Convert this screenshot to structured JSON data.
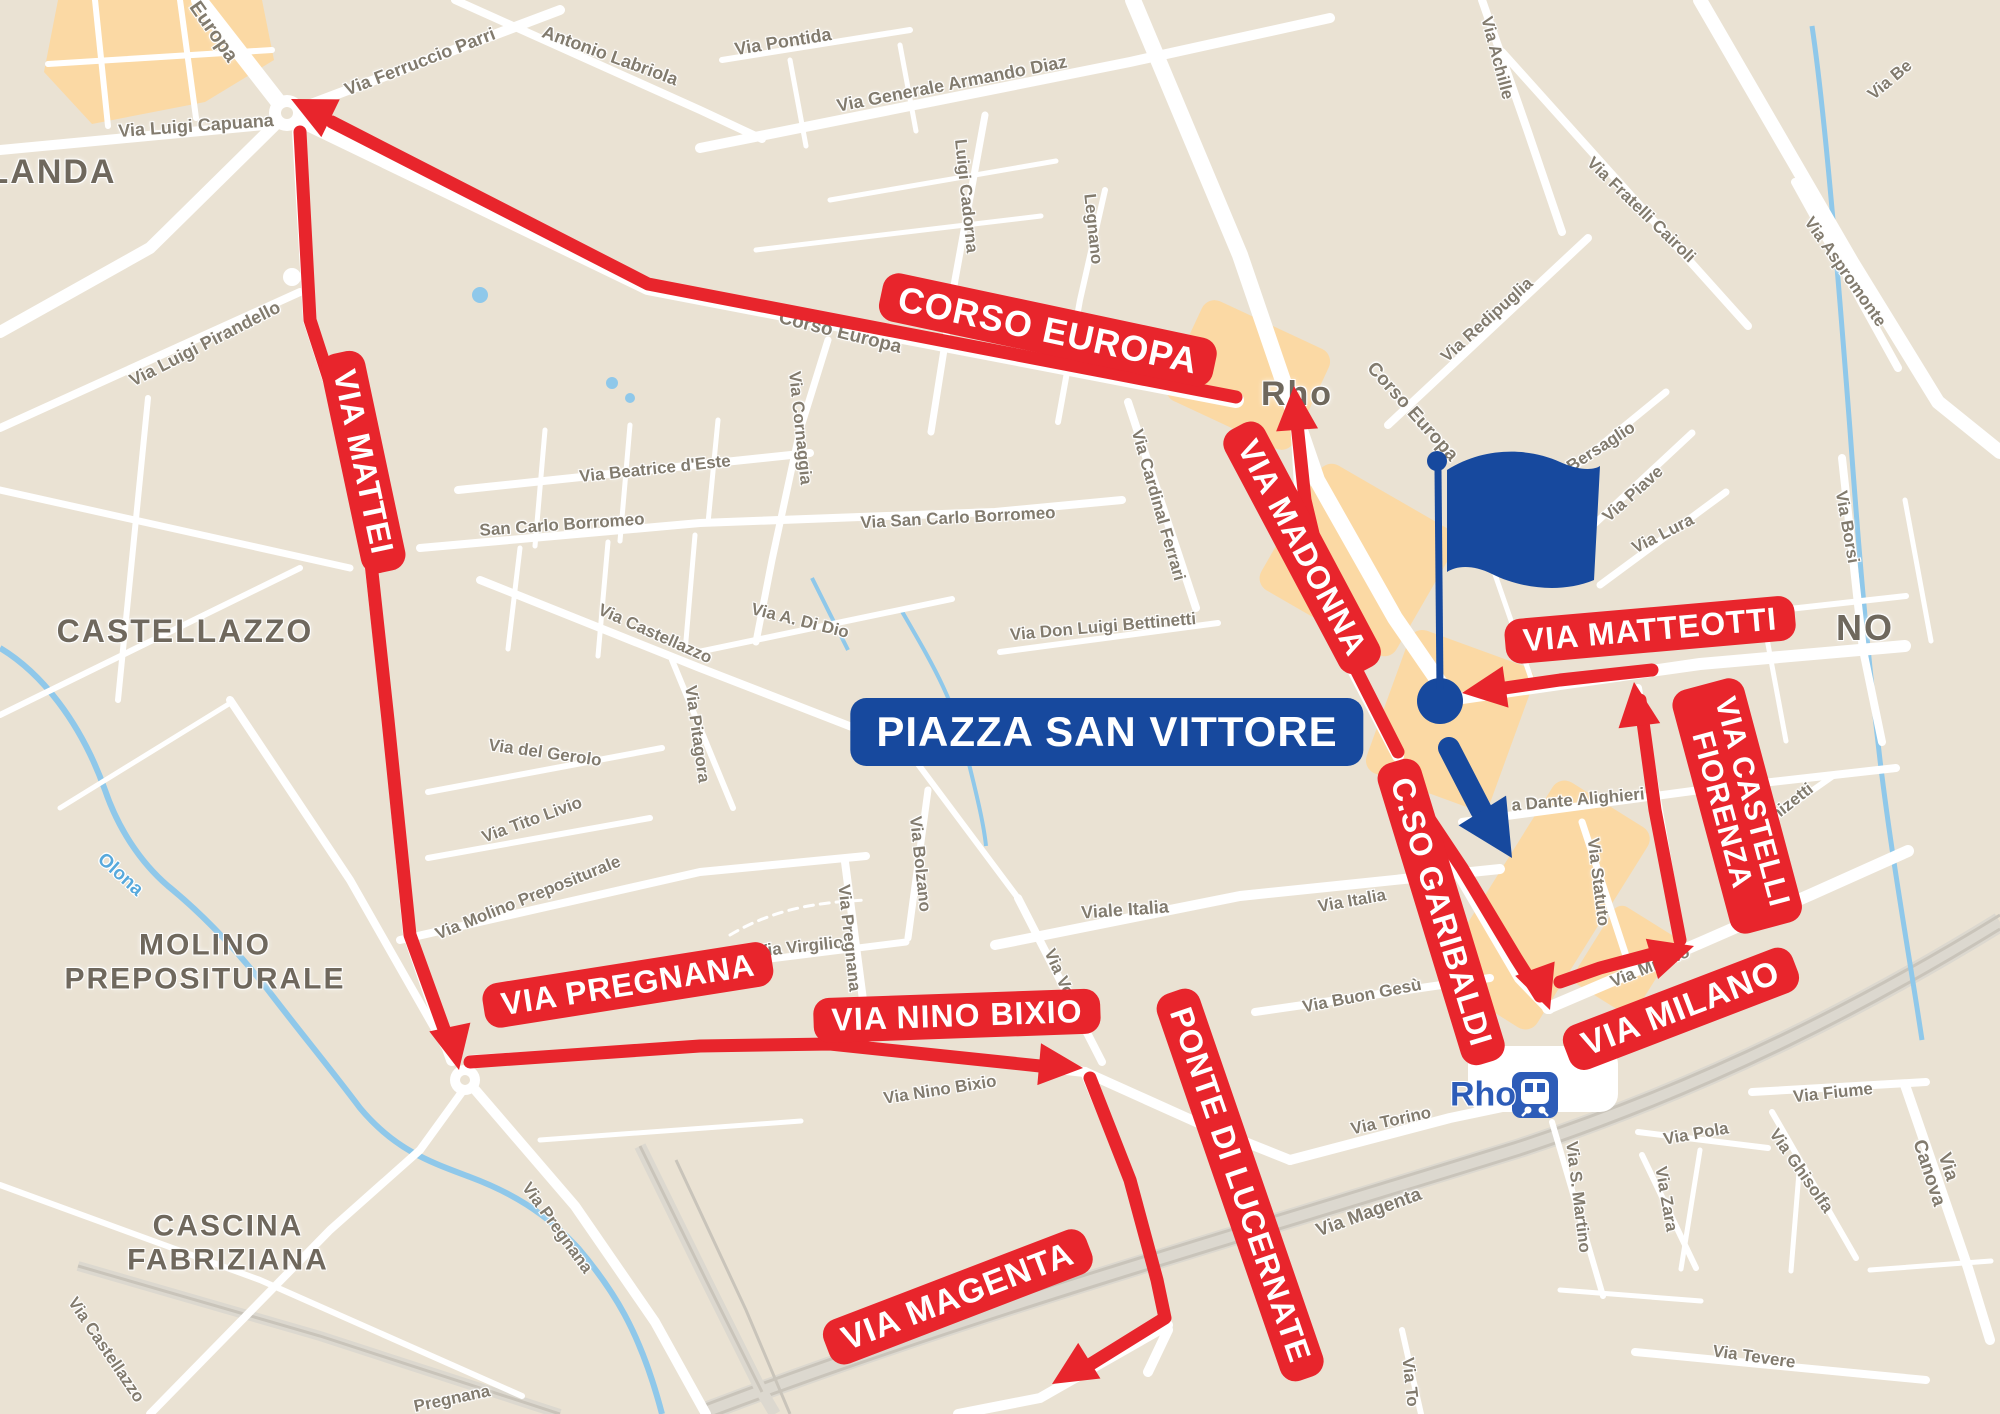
{
  "colors": {
    "route_red": "#e8252c",
    "brand_blue": "#17499e",
    "station_blue": "#2d5cb8",
    "land": "#eae2d3",
    "road": "#ffffff",
    "pedestrian_zone": "#fbd9a4",
    "water": "#8fc8ea",
    "railway": "#c9c4ba",
    "street_text": "#827b6e",
    "region_text": "#6f685d"
  },
  "piazza_label": {
    "text": "PIAZZA SAN VITTORE",
    "x": 1107,
    "y": 732,
    "size": 42
  },
  "station": {
    "name": "Rho",
    "x": 1483,
    "y": 1095,
    "size": 34
  },
  "icons": [
    "flag-icon",
    "piazza-marker-dot",
    "direction-arrow-icon",
    "train-icon",
    "route-arrowhead"
  ],
  "region_labels": [
    {
      "text": "LANDA",
      "x": 52,
      "y": 172,
      "rot": 0,
      "size": 34
    },
    {
      "text": "CASTELLAZZO",
      "x": 185,
      "y": 632,
      "rot": 0,
      "size": 32
    },
    {
      "text": "MOLINO\nPREPOSITURALE",
      "x": 205,
      "y": 962,
      "rot": 0,
      "size": 30
    },
    {
      "text": "CASCINA\nFABRIZIANA",
      "x": 228,
      "y": 1243,
      "rot": 0,
      "size": 30
    },
    {
      "text": "NO",
      "x": 1865,
      "y": 628,
      "rot": 0,
      "size": 36
    },
    {
      "text": "Rho",
      "x": 1297,
      "y": 394,
      "rot": 0,
      "size": 34
    }
  ],
  "water_labels": [
    {
      "text": "Olona",
      "x": 120,
      "y": 875,
      "rot": 42,
      "size": 19
    }
  ],
  "street_labels": [
    {
      "text": "Europa",
      "x": 213,
      "y": 32,
      "rot": 55,
      "size": 20
    },
    {
      "text": "Via Ferruccio Parri",
      "x": 420,
      "y": 62,
      "rot": -21,
      "size": 18
    },
    {
      "text": "Antonio Labriola",
      "x": 610,
      "y": 56,
      "rot": 20,
      "size": 18
    },
    {
      "text": "Via Pontida",
      "x": 783,
      "y": 42,
      "rot": -9,
      "size": 18
    },
    {
      "text": "Via Generale Armando Diaz",
      "x": 952,
      "y": 84,
      "rot": -11,
      "size": 18
    },
    {
      "text": "Via Luigi Capuana",
      "x": 196,
      "y": 126,
      "rot": -4,
      "size": 18
    },
    {
      "text": "Via Luigi Pirandello",
      "x": 205,
      "y": 344,
      "rot": -27,
      "size": 18
    },
    {
      "text": "Corso Europa",
      "x": 840,
      "y": 333,
      "rot": 14,
      "size": 19
    },
    {
      "text": "Corso Europa",
      "x": 1412,
      "y": 412,
      "rot": 48,
      "size": 19
    },
    {
      "text": "Via Cornaggia",
      "x": 800,
      "y": 428,
      "rot": 84,
      "size": 17
    },
    {
      "text": "Luigi Cadorna",
      "x": 966,
      "y": 196,
      "rot": 84,
      "size": 17
    },
    {
      "text": "Legnano",
      "x": 1093,
      "y": 229,
      "rot": 84,
      "size": 17
    },
    {
      "text": "Via Beatrice d'Este",
      "x": 655,
      "y": 469,
      "rot": -6,
      "size": 17
    },
    {
      "text": "San Carlo Borromeo",
      "x": 562,
      "y": 525,
      "rot": -4,
      "size": 17
    },
    {
      "text": "Via San Carlo Borromeo",
      "x": 958,
      "y": 518,
      "rot": -3,
      "size": 17
    },
    {
      "text": "Via Cardinal Ferrari",
      "x": 1158,
      "y": 505,
      "rot": 74,
      "size": 17
    },
    {
      "text": "Via A. Di Dio",
      "x": 800,
      "y": 621,
      "rot": 14,
      "size": 17
    },
    {
      "text": "Via Castellazzo",
      "x": 655,
      "y": 634,
      "rot": 24,
      "size": 17
    },
    {
      "text": "Via Don Luigi Bettinetti",
      "x": 1103,
      "y": 627,
      "rot": -5,
      "size": 17
    },
    {
      "text": "Via del Gerolo",
      "x": 545,
      "y": 753,
      "rot": 8,
      "size": 17
    },
    {
      "text": "Via Pitagora",
      "x": 697,
      "y": 734,
      "rot": 82,
      "size": 17
    },
    {
      "text": "Via Tito Livio",
      "x": 532,
      "y": 820,
      "rot": -20,
      "size": 17
    },
    {
      "text": "Via Molino Prepositurale",
      "x": 528,
      "y": 898,
      "rot": -22,
      "size": 17
    },
    {
      "text": "Via Virgilio",
      "x": 800,
      "y": 947,
      "rot": -6,
      "size": 17
    },
    {
      "text": "Via Bolzano",
      "x": 920,
      "y": 864,
      "rot": 84,
      "size": 17
    },
    {
      "text": "Viale Italia",
      "x": 1125,
      "y": 910,
      "rot": -4,
      "size": 18
    },
    {
      "text": "Via Italia",
      "x": 1352,
      "y": 901,
      "rot": -10,
      "size": 17
    },
    {
      "text": "Via Buon Gesù",
      "x": 1362,
      "y": 996,
      "rot": -11,
      "size": 17
    },
    {
      "text": "Via Volta",
      "x": 1063,
      "y": 982,
      "rot": 66,
      "size": 17
    },
    {
      "text": "Via Nino Bixio",
      "x": 940,
      "y": 1090,
      "rot": -9,
      "size": 17
    },
    {
      "text": "Via Pregnana",
      "x": 849,
      "y": 938,
      "rot": 84,
      "size": 17
    },
    {
      "text": "Via Pregnana",
      "x": 557,
      "y": 1228,
      "rot": 54,
      "size": 17
    },
    {
      "text": "Pregnana",
      "x": 452,
      "y": 1399,
      "rot": -12,
      "size": 17
    },
    {
      "text": "Via Castellazzo",
      "x": 106,
      "y": 1350,
      "rot": 56,
      "size": 17
    },
    {
      "text": "Via Fratelli Cairoli",
      "x": 1641,
      "y": 210,
      "rot": 44,
      "size": 17
    },
    {
      "text": "Via Achille",
      "x": 1497,
      "y": 58,
      "rot": 75,
      "size": 17
    },
    {
      "text": "Via Redipuglia",
      "x": 1487,
      "y": 320,
      "rot": -42,
      "size": 17
    },
    {
      "text": "Via Aspromonte",
      "x": 1845,
      "y": 272,
      "rot": 55,
      "size": 17
    },
    {
      "text": "Via Be",
      "x": 1890,
      "y": 80,
      "rot": -40,
      "size": 17
    },
    {
      "text": "Via Piave",
      "x": 1633,
      "y": 494,
      "rot": -42,
      "size": 17
    },
    {
      "text": "Via Lura",
      "x": 1663,
      "y": 534,
      "rot": -27,
      "size": 17
    },
    {
      "text": "Bersaglio",
      "x": 1601,
      "y": 447,
      "rot": -33,
      "size": 17
    },
    {
      "text": "Via Borsi",
      "x": 1847,
      "y": 527,
      "rot": 80,
      "size": 17
    },
    {
      "text": "a Dante Alighieri",
      "x": 1578,
      "y": 800,
      "rot": -5,
      "size": 17
    },
    {
      "text": "Via Statuto",
      "x": 1598,
      "y": 882,
      "rot": 83,
      "size": 17
    },
    {
      "text": "Donizetti",
      "x": 1783,
      "y": 809,
      "rot": -38,
      "size": 17
    },
    {
      "text": "Via Milano",
      "x": 1650,
      "y": 967,
      "rot": -22,
      "size": 17
    },
    {
      "text": "Via Torino",
      "x": 1391,
      "y": 1121,
      "rot": -12,
      "size": 17
    },
    {
      "text": "Via Magenta",
      "x": 1369,
      "y": 1213,
      "rot": -20,
      "size": 19
    },
    {
      "text": "Via Fiume",
      "x": 1833,
      "y": 1093,
      "rot": -6,
      "size": 17
    },
    {
      "text": "Via Pola",
      "x": 1696,
      "y": 1134,
      "rot": -10,
      "size": 17
    },
    {
      "text": "Via Ghisolfa",
      "x": 1801,
      "y": 1171,
      "rot": 55,
      "size": 17
    },
    {
      "text": "Via Canova",
      "x": 1938,
      "y": 1170,
      "rot": 72,
      "size": 19
    },
    {
      "text": "Via S. Martino",
      "x": 1578,
      "y": 1197,
      "rot": 83,
      "size": 17
    },
    {
      "text": "Via Zara",
      "x": 1666,
      "y": 1199,
      "rot": 80,
      "size": 17
    },
    {
      "text": "Via Tevere",
      "x": 1754,
      "y": 1357,
      "rot": 8,
      "size": 17
    },
    {
      "text": "Via To",
      "x": 1410,
      "y": 1382,
      "rot": 84,
      "size": 17
    }
  ],
  "route_labels": [
    {
      "text": "CORSO EUROPA",
      "x": 1048,
      "y": 330,
      "rot": 12,
      "size": 36
    },
    {
      "text": "VIA MATTEI",
      "x": 363,
      "y": 462,
      "rot": 78,
      "size": 32
    },
    {
      "text": "VIA MADONNA",
      "x": 1302,
      "y": 548,
      "rot": 62,
      "size": 32
    },
    {
      "text": "VIA MATTEOTTI",
      "x": 1650,
      "y": 630,
      "rot": -5,
      "size": 32
    },
    {
      "text": "VIA CASTELLI\nFIORENZA",
      "x": 1737,
      "y": 806,
      "rot": 75,
      "size": 30
    },
    {
      "text": "C.SO GARIBALDI",
      "x": 1441,
      "y": 912,
      "rot": 73,
      "size": 32
    },
    {
      "text": "VIA MILANO",
      "x": 1681,
      "y": 1009,
      "rot": -21,
      "size": 34
    },
    {
      "text": "VIA PREGNANA",
      "x": 628,
      "y": 985,
      "rot": -9,
      "size": 32
    },
    {
      "text": "VIA NINO BIXIO",
      "x": 957,
      "y": 1016,
      "rot": -2,
      "size": 32
    },
    {
      "text": "PONTE DI LUCERNATE",
      "x": 1240,
      "y": 1185,
      "rot": 71,
      "size": 32
    },
    {
      "text": "VIA MAGENTA",
      "x": 958,
      "y": 1297,
      "rot": -21,
      "size": 34
    }
  ]
}
